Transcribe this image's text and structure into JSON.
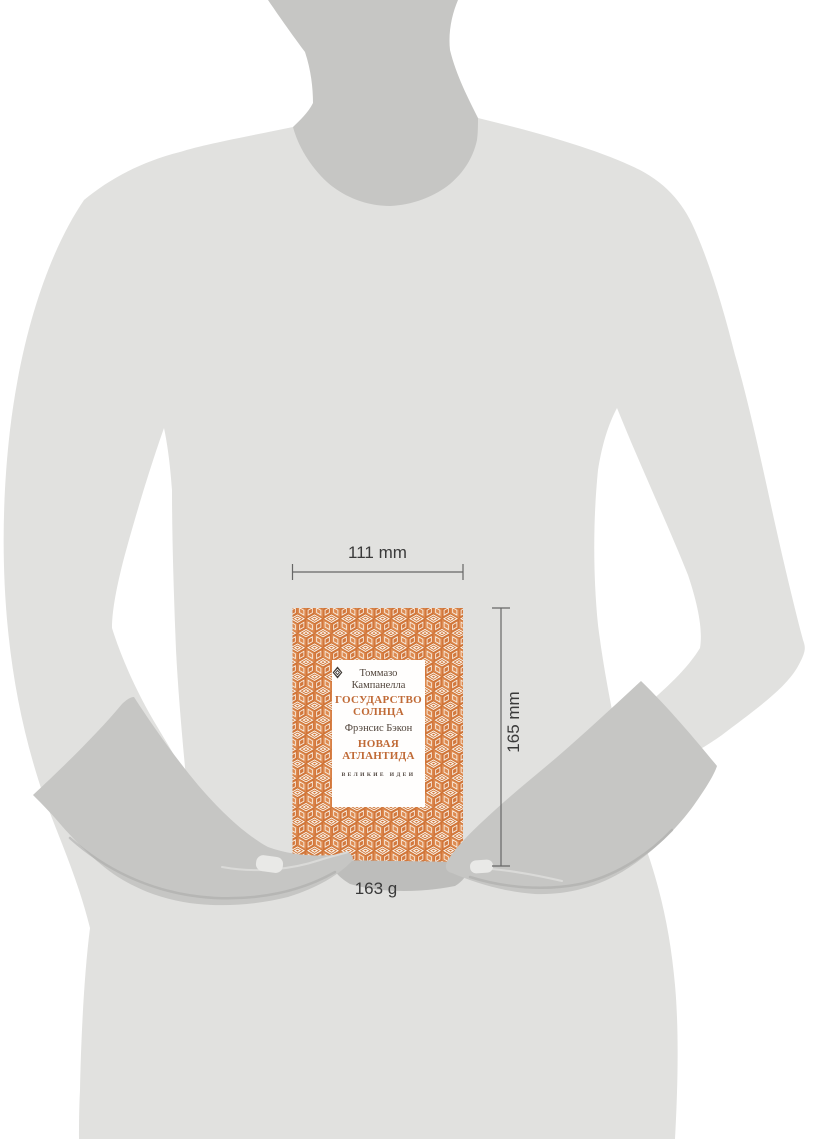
{
  "annotations": {
    "width": "111 mm",
    "height": "165 mm",
    "weight": "163 g"
  },
  "book_cover": {
    "author_top": "Томмазо Кампанелла",
    "title_top": "ГОСУДАРСТВО СОЛНЦА",
    "author_bottom": "Фрэнсис Бэкон",
    "title_bottom": "НОВАЯ АТЛАНТИДА",
    "series": "ВЕЛИКИЕ ИДЕИ",
    "ornament_icon": "diamond-ornament"
  },
  "colors": {
    "background": "#ffffff",
    "silhouette_body": "#e1e1df",
    "silhouette_dark": "#c6c6c4",
    "seam_shadow": "#a9a9a7",
    "highlight": "#e9e9e7",
    "book_shadow": "#bdbdbb",
    "pattern_orange": "#dd8a50",
    "pattern_orange_dark": "#d2773c",
    "pattern_outline": "#cf7436",
    "pattern_cream": "#fbf4ec",
    "label_background": "#fffefd",
    "label_dark_text": "#51453c",
    "label_orange_text": "#c06a36",
    "dimension_line": "#666666",
    "dimension_text": "#3a3a3a"
  }
}
